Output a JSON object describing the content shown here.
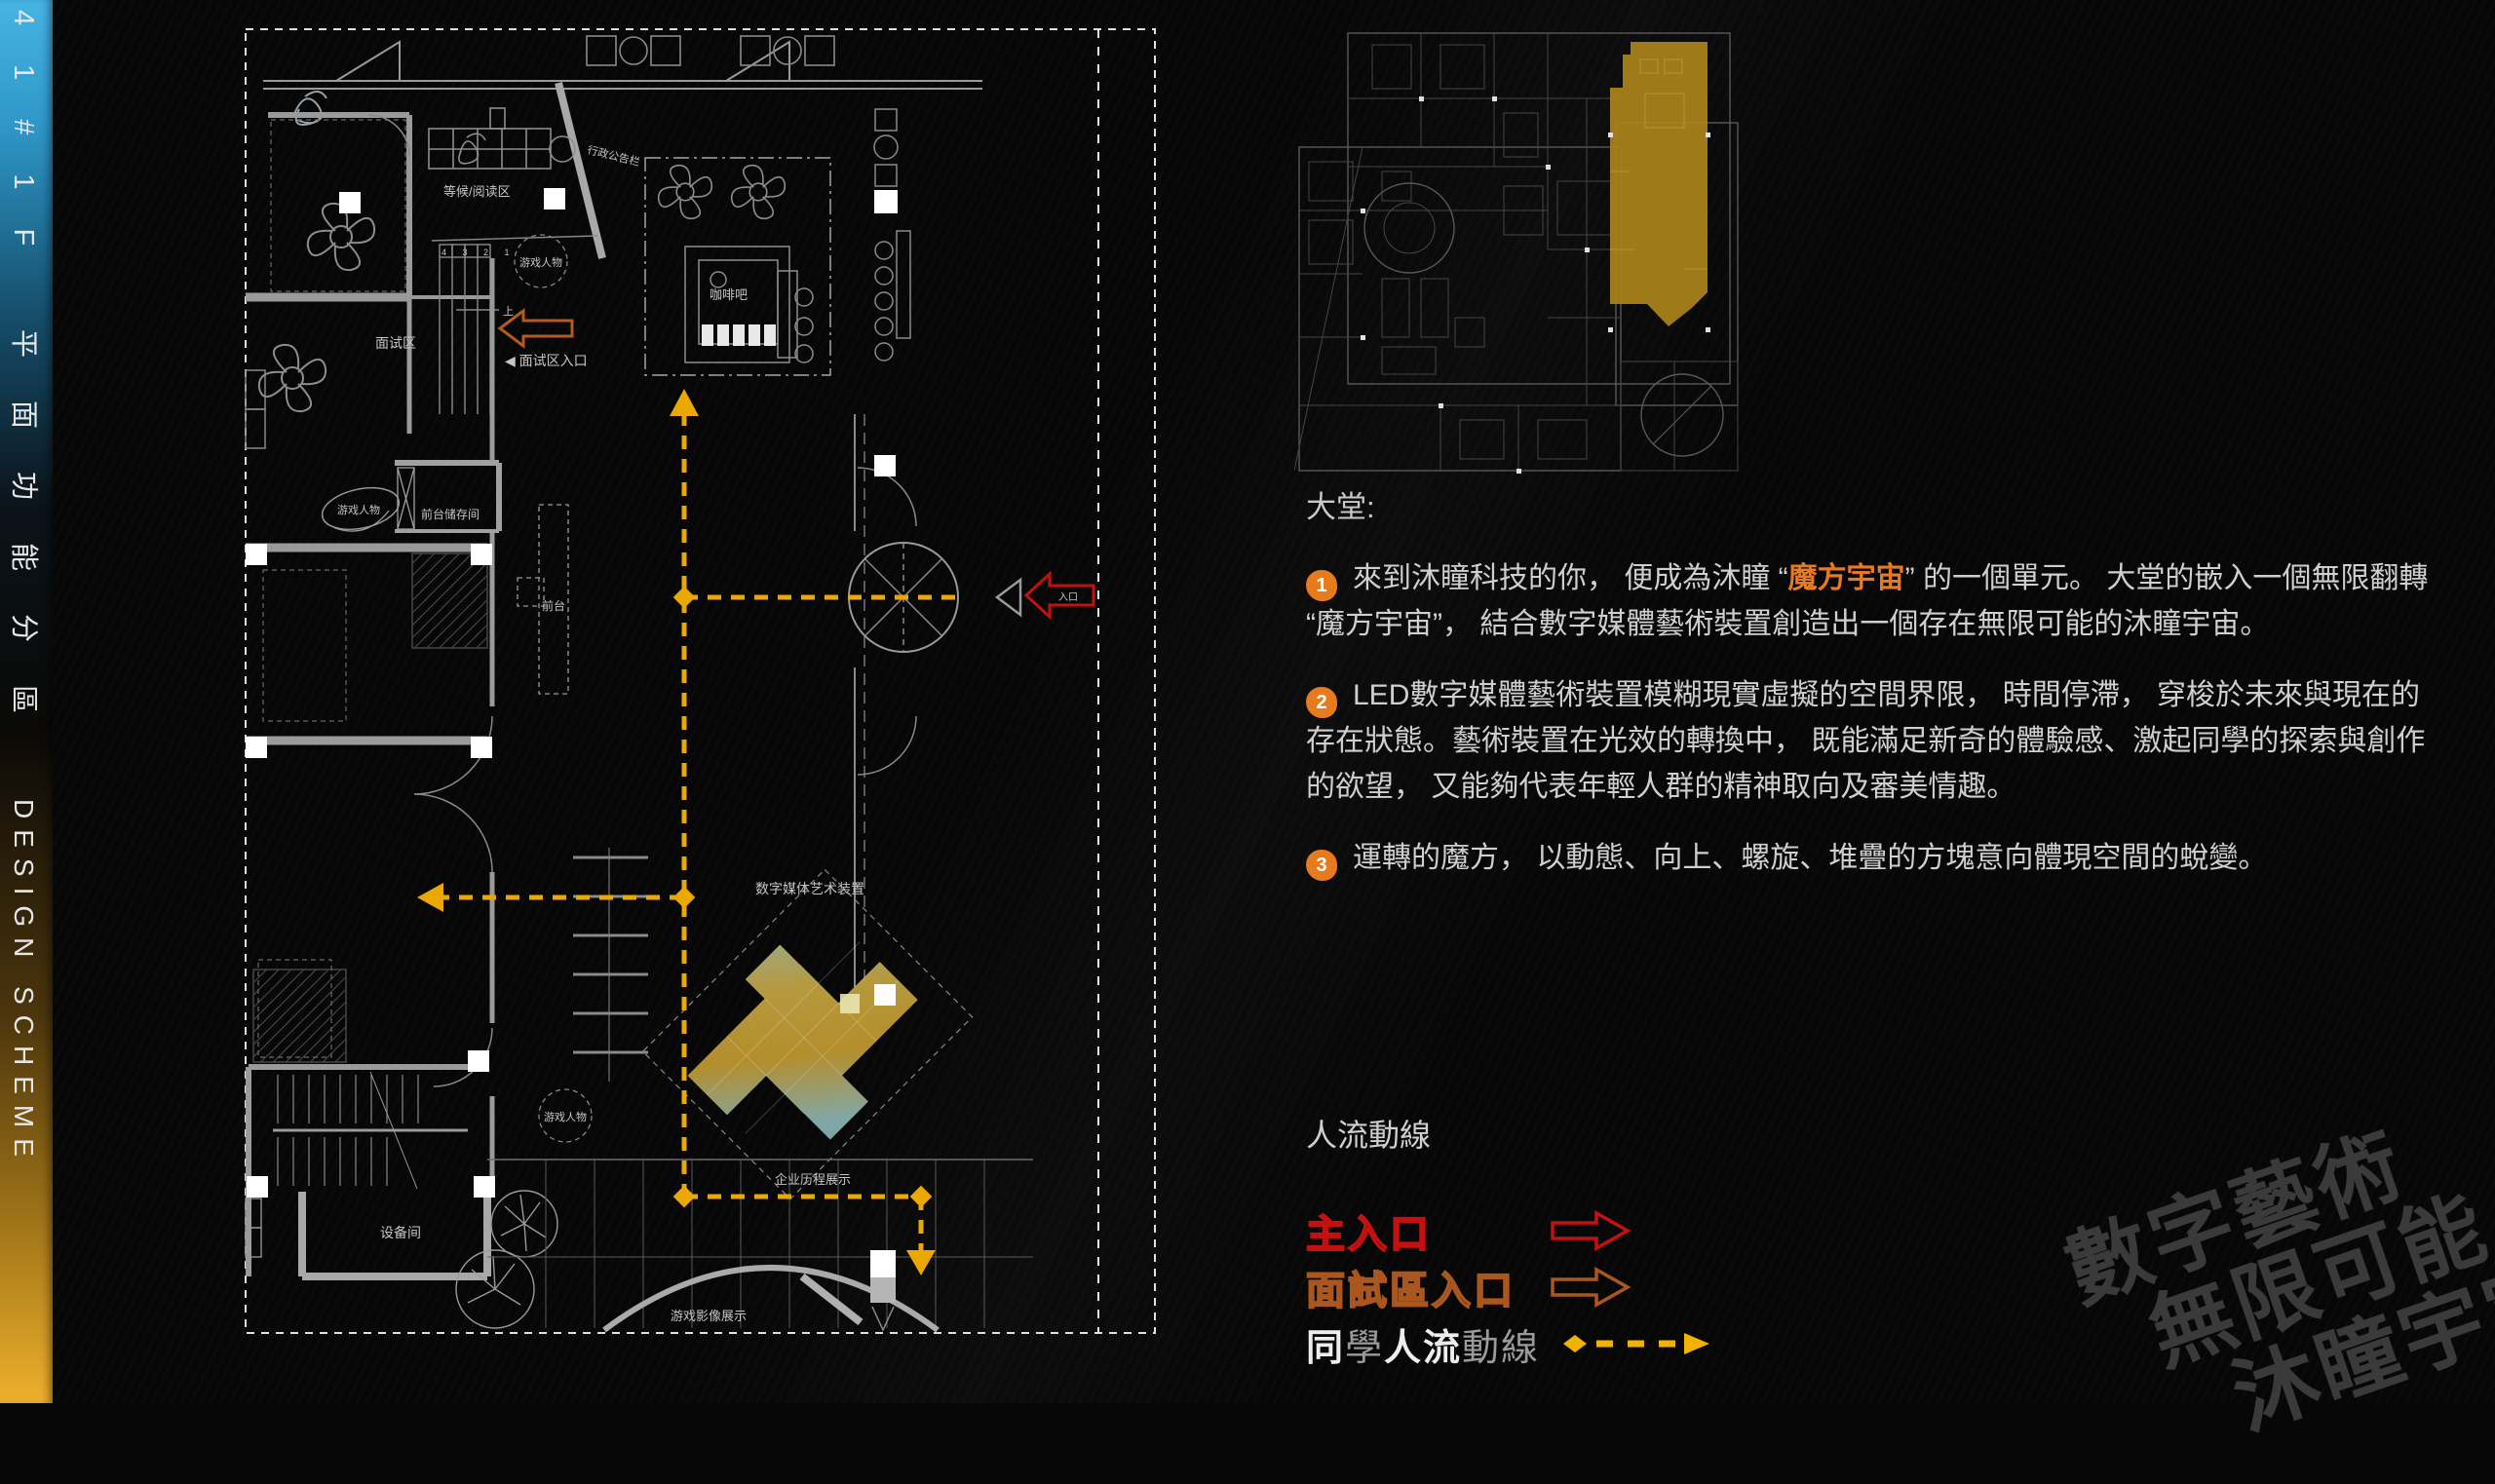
{
  "sidebar": {
    "code": "41#1F",
    "title_cjk": "平面功能分區",
    "title_en": "DESIGN SCHEME"
  },
  "plan": {
    "labels": {
      "waiting": "等候/阅读区",
      "notice_board": "行政公告栏",
      "coffee_bar": "咖啡吧",
      "interview": "面试区",
      "interview_entrance": "◀ 面试区入口",
      "game_figure": "游戏人物",
      "front_desk_storage": "前台储存间",
      "front_desk": "前台",
      "media_art": "数字媒体艺术装置",
      "history_display": "企业历程展示",
      "equipment_room": "设备间",
      "game_video": "游戏影像展示",
      "up": "上",
      "entrance": "入口",
      "queue_numbers": "4 3 2 1"
    }
  },
  "content": {
    "heading": "大堂:",
    "points": [
      {
        "num": "1",
        "segments": [
          {
            "t": "來到沐瞳科技的你， 便成為沐瞳 “"
          },
          {
            "t": "魔方宇宙",
            "c": "hl"
          },
          {
            "t": "” 的一個單元。 大堂的嵌入一個無限翻轉 “魔方宇宙”， 結合數字媒體藝術裝置創造出一個存在無限可能的沐瞳宇宙。"
          }
        ]
      },
      {
        "num": "2",
        "segments": [
          {
            "t": "LED數字媒體藝術裝置模糊現實虛擬的空間界限， 時間停滯， 穿梭於未來與現在的存在狀態。藝術裝置在光效的轉換中， 既能滿足新奇的體驗感、激起同學的探索與創作的欲望， 又能夠代表年輕人群的精神取向及審美情趣。"
          }
        ]
      },
      {
        "num": "3",
        "segments": [
          {
            "t": "運轉的魔方， 以動態、向上、螺旋、堆疊的方塊意向體現空間的蛻變。"
          }
        ]
      }
    ]
  },
  "legend": {
    "title": "人流動線",
    "main_entrance": "主入口",
    "interview_entrance": "面試區入口",
    "flow_line_parts": [
      {
        "t": "同",
        "c": "wb"
      },
      {
        "t": "學",
        "c": "gr"
      },
      {
        "t": "人流",
        "c": "wb"
      },
      {
        "t": "動線",
        "c": "gr"
      }
    ]
  },
  "watermark": {
    "line1": "數字藝術",
    "line2": "無限可能",
    "line3": "沐瞳宇宙"
  },
  "colors": {
    "accent_orange": "#e87a1e",
    "path_yellow": "#eaa800",
    "entry_red": "#c51010",
    "interview_orange": "#a9571e",
    "minimap_gold": "#aa831b",
    "sidebar_top": "#3aa6d8",
    "sidebar_bottom": "#eeb02c"
  }
}
